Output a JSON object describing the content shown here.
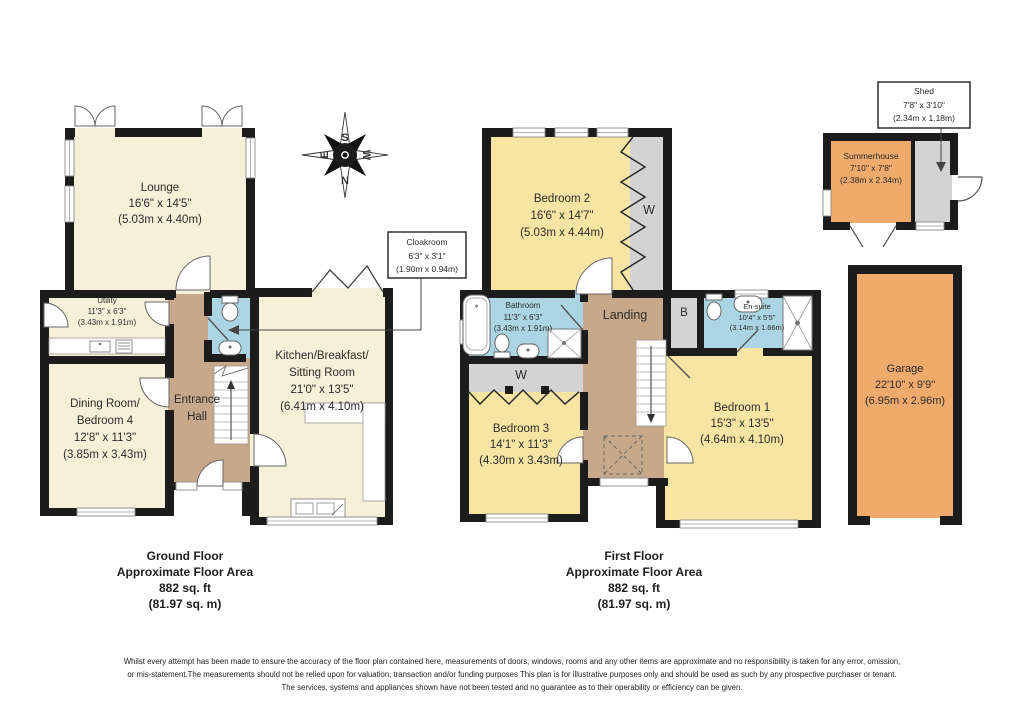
{
  "plan": {
    "ground_floor": {
      "title": [
        "Ground Floor",
        "Approximate Floor Area",
        "882 sq. ft",
        "(81.97 sq. m)"
      ],
      "rooms": {
        "lounge": [
          "Lounge",
          "16'6\" x 14'5\"",
          "(5.03m x 4.40m)"
        ],
        "utility": [
          "Utility",
          "11'3\" x 6'3\"",
          "(3.43m x 1.91m)"
        ],
        "dining_room_bedroom4": [
          "Dining Room/",
          "Bedroom 4",
          "12'8\" x 11'3\"",
          "(3.85m x 3.43m)"
        ],
        "entrance_hall": [
          "Entrance",
          "Hall"
        ],
        "kitchen": [
          "Kitchen/Breakfast/",
          "Sitting Room",
          "21'0\" x 13'5\"",
          "(6.41m x 4.10m)"
        ],
        "cloakroom": [
          "Cloakroom",
          "6'3\" x 3'1\"",
          "(1.90m x 0.94m)"
        ]
      }
    },
    "first_floor": {
      "title": [
        "First Floor",
        "Approximate Floor Area",
        "882 sq. ft",
        "(81.97 sq. m)"
      ],
      "rooms": {
        "bedroom2": [
          "Bedroom 2",
          "16'6\" x 14'7\"",
          "(5.03m x 4.44m)"
        ],
        "bathroom": [
          "Bathroom",
          "11'3\" x 6'3\"",
          "(3.43m x 1.91m)"
        ],
        "landing": [
          "Landing"
        ],
        "boiler": [
          "B"
        ],
        "ensuite": [
          "En-suite",
          "10'4\" x 5'5\"",
          "(3.14m x 1.66m)"
        ],
        "bedroom3": [
          "Bedroom 3",
          "14'1\" x 11'3\"",
          "(4.30m x 3.43m)"
        ],
        "bedroom1": [
          "Bedroom 1",
          "15'3\" x 13'5\"",
          "(4.64m x 4.10m)"
        ],
        "wardrobe": [
          "W"
        ]
      }
    },
    "outbuildings": {
      "shed": [
        "Shed",
        "7'8\" x 3'10\"",
        "(2.34m x 1.18m)"
      ],
      "summerhouse": [
        "Summerhouse",
        "7'10\" x 7'8\"",
        "(2.38m x 2.34m)"
      ],
      "garage": [
        "Garage",
        "22'10\" x 9'9\"",
        "(6.95m x 2.96m)"
      ]
    },
    "compass": {
      "north": "N",
      "south": "S",
      "east": "E",
      "west": "W"
    },
    "footer": [
      "Whilst every attempt has been made to ensure the accuracy of the floor plan contained here, measurements of doors, windows, rooms and any other items are approximate and no responsibility is taken for any error, omission,",
      "or mis-statement.The measurements should not be relied upon for valuation, transaction and/or funding purposes This plan is for illustrative purposes only and should be used as such by any prospective purchaser or tenant.",
      "The services, systems and appliances shown have not been tested and no guarantee as to their operability or efficiency can be given."
    ],
    "colors": {
      "wall": "#1c1c1c",
      "ground_rooms": "#F7F0D9",
      "bedrooms": "#F8E5A3",
      "wet_rooms": "#ABD5E3",
      "hall_landing": "#C8A88A",
      "outbuilding": "#EFAA6C",
      "storage_grey": "#D3D3D3"
    }
  }
}
